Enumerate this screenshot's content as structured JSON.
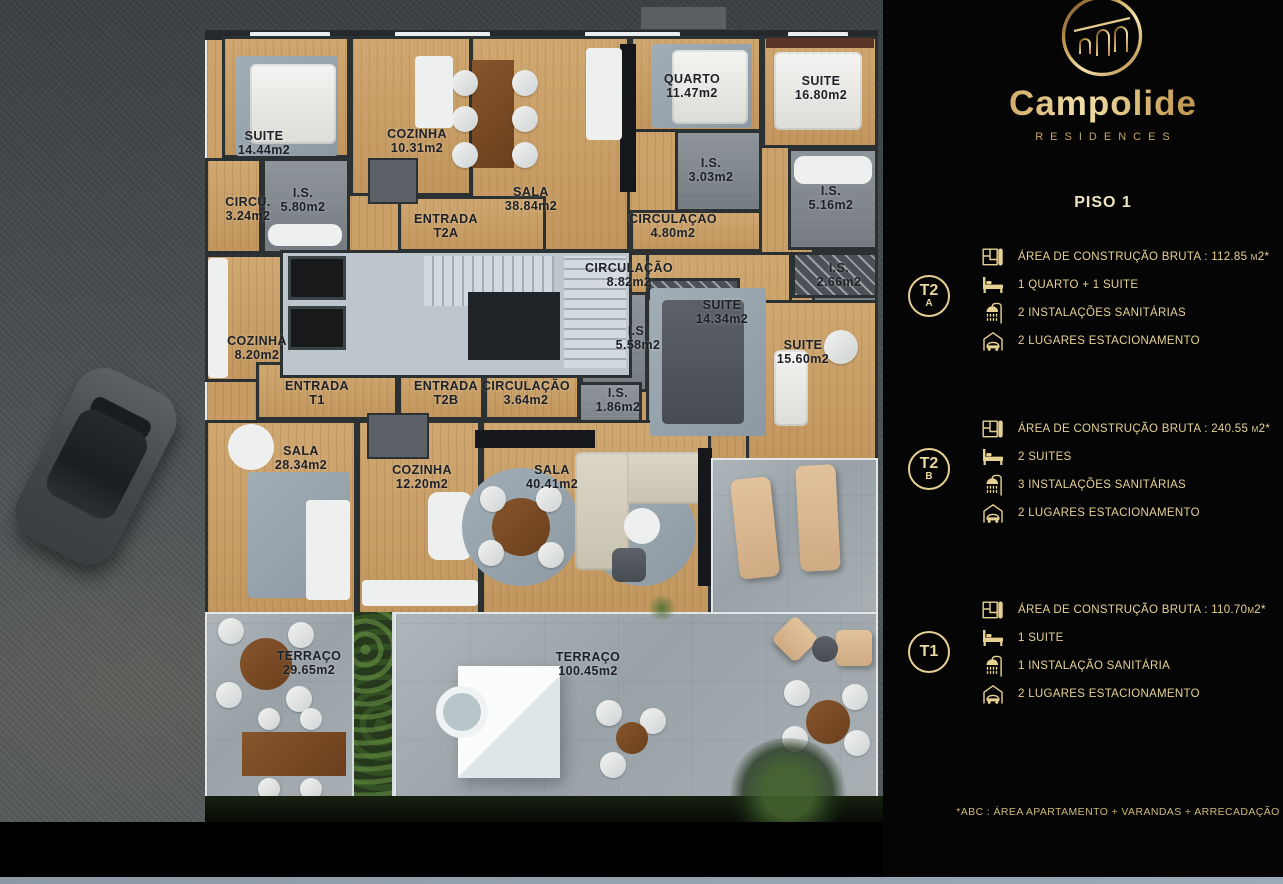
{
  "colors": {
    "panel_background": "#050505",
    "gold_accent": "#e6d193",
    "gold_gradient_light": "#f0dfa8",
    "gold_gradient_dark": "#7a5323",
    "wood_floor": "#c89a63",
    "wall": "#2b3033",
    "terrace_concrete": "#a2abaf",
    "hedge_green": "#2e4a2c"
  },
  "brand": {
    "name": "Campolide",
    "subtitle": "RESIDENCES",
    "logo": "aqueduct-arches-in-circle"
  },
  "page": {
    "floor_label": "PISO 1",
    "footnote": "*ABC :  ÁREA APARTAMENTO + VARANDAS + ARRECADAÇÃO"
  },
  "units": [
    {
      "id": "T2A",
      "badge": {
        "line1": "T2",
        "line2": "A"
      },
      "specs": [
        {
          "icon": "floorplan-icon",
          "label": "ÁREA DE CONSTRUÇÃO BRUTA :  112.85 m2*"
        },
        {
          "icon": "bed-icon",
          "label": "1 QUARTO + 1 SUITE"
        },
        {
          "icon": "shower-icon",
          "label": "2 INSTALAÇÕES SANITÁRIAS"
        },
        {
          "icon": "garage-icon",
          "label": "2 LUGARES ESTACIONAMENTO"
        }
      ]
    },
    {
      "id": "T2B",
      "badge": {
        "line1": "T2",
        "line2": "B"
      },
      "specs": [
        {
          "icon": "floorplan-icon",
          "label": "ÁREA DE CONSTRUÇÃO BRUTA :  240.55 m2*"
        },
        {
          "icon": "bed-icon",
          "label": "2 SUITES"
        },
        {
          "icon": "shower-icon",
          "label": "3 INSTALAÇÕES SANITÁRIAS"
        },
        {
          "icon": "garage-icon",
          "label": "2 LUGARES ESTACIONAMENTO"
        }
      ]
    },
    {
      "id": "T1",
      "badge": {
        "line1": "T1",
        "line2": ""
      },
      "specs": [
        {
          "icon": "floorplan-icon",
          "label": "ÁREA DE CONSTRUÇÃO BRUTA :  110.70m2*"
        },
        {
          "icon": "bed-icon",
          "label": "1 SUITE"
        },
        {
          "icon": "shower-icon",
          "label": "1 INSTALAÇÃO SANITÁRIA"
        },
        {
          "icon": "garage-icon",
          "label": "2 LUGARES ESTACIONAMENTO"
        }
      ]
    }
  ],
  "floorplan": {
    "rooms": [
      {
        "name": "SUITE",
        "area": "14.44m2"
      },
      {
        "name": "COZINHA",
        "area": "10.31m2"
      },
      {
        "name": "SALA",
        "area": "38.84m2"
      },
      {
        "name": "QUARTO",
        "area": "11.47m2"
      },
      {
        "name": "SUITE",
        "area": "16.80m2"
      },
      {
        "name": "I.S.",
        "area": "5.80m2"
      },
      {
        "name": "CIRCU.",
        "area": "3.24m2"
      },
      {
        "name": "I.S.",
        "area": "3.03m2"
      },
      {
        "name": "CIRCULAÇÃO",
        "area": "4.80m2"
      },
      {
        "name": "I.S.",
        "area": "5.16m2"
      },
      {
        "name": "ENTRADA",
        "area": "T2A"
      },
      {
        "name": "CIRCULAÇÃO",
        "area": "8.82m2"
      },
      {
        "name": "I.S.",
        "area": "2.66m2"
      },
      {
        "name": "SUITE",
        "area": "14.34m2"
      },
      {
        "name": "I.S.",
        "area": "5.58m2"
      },
      {
        "name": "SUITE",
        "area": "15.60m2"
      },
      {
        "name": "I.S.",
        "area": "1.86m2"
      },
      {
        "name": "COZINHA",
        "area": "8.20m2"
      },
      {
        "name": "ENTRADA",
        "area": "T1"
      },
      {
        "name": "ENTRADA",
        "area": "T2B"
      },
      {
        "name": "CIRCULAÇÃO",
        "area": "3.64m2"
      },
      {
        "name": "SALA",
        "area": "28.34m2"
      },
      {
        "name": "COZINHA",
        "area": "12.20m2"
      },
      {
        "name": "SALA",
        "area": "40.41m2"
      },
      {
        "name": "TERRAÇO",
        "area": "29.65m2"
      },
      {
        "name": "TERRAÇO",
        "area": "100.45m2"
      }
    ]
  }
}
